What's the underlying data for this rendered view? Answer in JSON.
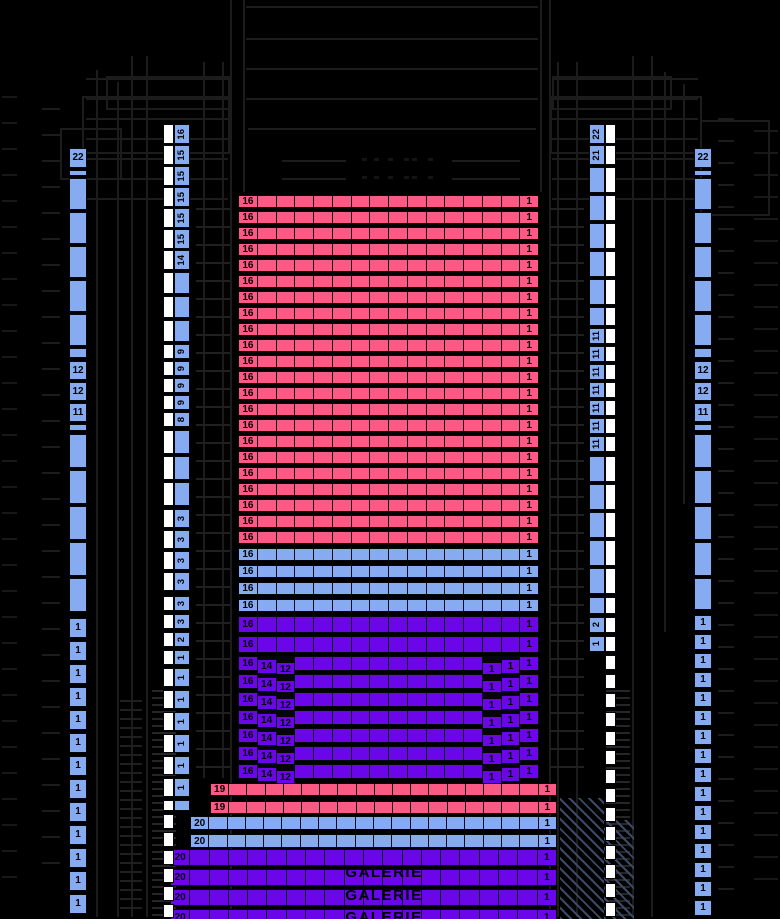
{
  "galerie": {
    "label": "GALERIE",
    "repeat": 3
  },
  "colors": {
    "pink": "#fb5a84",
    "lightblue": "#87abf1",
    "purple": "#6b06e8",
    "white": "#ffffff",
    "architecture_line": "#1c1c1c"
  },
  "parterre": {
    "pink": {
      "rows": 22,
      "seats": 16,
      "left_label": "16",
      "right_label": "1"
    },
    "lightblue": {
      "rows": 4,
      "seats": 16,
      "left_label": "16",
      "right_label": "1"
    },
    "purple_full": {
      "rows": 2,
      "seats": 16,
      "left_label": "16",
      "right_label": "1"
    },
    "purple_stepped": {
      "rows": 7,
      "seats": 16,
      "left_labels": [
        "16",
        "14",
        "12"
      ],
      "right_labels": [
        "1",
        "1",
        "1"
      ]
    }
  },
  "gallery": {
    "pink": {
      "rows": 2,
      "seats": 19,
      "left_label": "19",
      "right_label": "1"
    },
    "lightblue": {
      "rows": 2,
      "seats": 20,
      "left_label": "20",
      "right_label": "1"
    },
    "purple": {
      "rows": 4,
      "seats": 20,
      "left_label": "20",
      "right_label": "1"
    }
  },
  "strips": {
    "outer_left": [
      {
        "y": 148,
        "h": 20,
        "t": "22"
      },
      {
        "y": 170,
        "h": 6,
        "t": ""
      },
      {
        "y": 178,
        "h": 32,
        "t": ""
      },
      {
        "y": 212,
        "h": 32,
        "t": ""
      },
      {
        "y": 246,
        "h": 32,
        "t": ""
      },
      {
        "y": 280,
        "h": 32,
        "t": ""
      },
      {
        "y": 314,
        "h": 32,
        "t": ""
      },
      {
        "y": 348,
        "h": 10,
        "t": ""
      },
      {
        "y": 361,
        "h": 19,
        "t": "12"
      },
      {
        "y": 382,
        "h": 19,
        "t": "12"
      },
      {
        "y": 403,
        "h": 19,
        "t": "11"
      },
      {
        "y": 424,
        "h": 7,
        "t": ""
      },
      {
        "y": 434,
        "h": 34,
        "t": ""
      },
      {
        "y": 470,
        "h": 34,
        "t": ""
      },
      {
        "y": 506,
        "h": 34,
        "t": ""
      },
      {
        "y": 542,
        "h": 34,
        "t": ""
      },
      {
        "y": 578,
        "h": 34,
        "t": ""
      },
      {
        "y": 618,
        "h": 20,
        "t": "1"
      },
      {
        "y": 641,
        "h": 20,
        "t": "1"
      },
      {
        "y": 664,
        "h": 20,
        "t": "1"
      },
      {
        "y": 687,
        "h": 20,
        "t": "1"
      },
      {
        "y": 710,
        "h": 20,
        "t": "1"
      },
      {
        "y": 733,
        "h": 20,
        "t": "1"
      },
      {
        "y": 756,
        "h": 20,
        "t": "1"
      },
      {
        "y": 779,
        "h": 20,
        "t": "1"
      },
      {
        "y": 802,
        "h": 20,
        "t": "1"
      },
      {
        "y": 825,
        "h": 20,
        "t": "1"
      },
      {
        "y": 848,
        "h": 20,
        "t": "1"
      },
      {
        "y": 871,
        "h": 20,
        "t": "1"
      },
      {
        "y": 894,
        "h": 20,
        "t": "1"
      }
    ],
    "outer_right": [
      {
        "y": 148,
        "h": 20,
        "t": "22"
      },
      {
        "y": 170,
        "h": 6,
        "t": ""
      },
      {
        "y": 178,
        "h": 32,
        "t": ""
      },
      {
        "y": 212,
        "h": 32,
        "t": ""
      },
      {
        "y": 246,
        "h": 32,
        "t": ""
      },
      {
        "y": 280,
        "h": 32,
        "t": ""
      },
      {
        "y": 314,
        "h": 32,
        "t": ""
      },
      {
        "y": 348,
        "h": 10,
        "t": ""
      },
      {
        "y": 361,
        "h": 19,
        "t": "12"
      },
      {
        "y": 382,
        "h": 19,
        "t": "12"
      },
      {
        "y": 403,
        "h": 19,
        "t": "11"
      },
      {
        "y": 424,
        "h": 7,
        "t": ""
      },
      {
        "y": 434,
        "h": 34,
        "t": ""
      },
      {
        "y": 470,
        "h": 34,
        "t": ""
      },
      {
        "y": 506,
        "h": 34,
        "t": ""
      },
      {
        "y": 542,
        "h": 34,
        "t": ""
      },
      {
        "y": 578,
        "h": 32,
        "t": ""
      },
      {
        "y": 615,
        "h": 16,
        "t": "1"
      },
      {
        "y": 634,
        "h": 16,
        "t": "1"
      },
      {
        "y": 653,
        "h": 16,
        "t": "1"
      },
      {
        "y": 672,
        "h": 16,
        "t": "1"
      },
      {
        "y": 691,
        "h": 16,
        "t": "1"
      },
      {
        "y": 710,
        "h": 16,
        "t": "1"
      },
      {
        "y": 729,
        "h": 16,
        "t": "1"
      },
      {
        "y": 748,
        "h": 16,
        "t": "1"
      },
      {
        "y": 767,
        "h": 16,
        "t": "1"
      },
      {
        "y": 786,
        "h": 16,
        "t": "1"
      },
      {
        "y": 805,
        "h": 16,
        "t": "1"
      },
      {
        "y": 824,
        "h": 16,
        "t": "1"
      },
      {
        "y": 843,
        "h": 16,
        "t": "1"
      },
      {
        "y": 862,
        "h": 16,
        "t": "1"
      },
      {
        "y": 881,
        "h": 16,
        "t": "1"
      },
      {
        "y": 900,
        "h": 16,
        "t": "1"
      }
    ],
    "inner_left": [
      {
        "y": 124,
        "h": 20,
        "t": "16"
      },
      {
        "y": 145,
        "h": 20,
        "t": "15"
      },
      {
        "y": 166,
        "h": 20,
        "t": "15"
      },
      {
        "y": 187,
        "h": 20,
        "t": "15"
      },
      {
        "y": 208,
        "h": 20,
        "t": "15"
      },
      {
        "y": 229,
        "h": 20,
        "t": "15"
      },
      {
        "y": 250,
        "h": 20,
        "t": "14"
      },
      {
        "y": 272,
        "h": 22,
        "t": ""
      },
      {
        "y": 296,
        "h": 22,
        "t": ""
      },
      {
        "y": 320,
        "h": 22,
        "t": ""
      },
      {
        "y": 344,
        "h": 15,
        "t": "9"
      },
      {
        "y": 361,
        "h": 15,
        "t": "9"
      },
      {
        "y": 378,
        "h": 15,
        "t": "9"
      },
      {
        "y": 395,
        "h": 15,
        "t": "9"
      },
      {
        "y": 412,
        "h": 15,
        "t": "8"
      },
      {
        "y": 430,
        "h": 24,
        "t": ""
      },
      {
        "y": 456,
        "h": 24,
        "t": ""
      },
      {
        "y": 482,
        "h": 24,
        "t": ""
      },
      {
        "y": 509,
        "h": 19,
        "t": "3"
      },
      {
        "y": 530,
        "h": 19,
        "t": "3"
      },
      {
        "y": 551,
        "h": 19,
        "t": "3"
      },
      {
        "y": 572,
        "h": 19,
        "t": "3"
      },
      {
        "y": 596,
        "h": 15,
        "t": "3"
      },
      {
        "y": 614,
        "h": 15,
        "t": "3"
      },
      {
        "y": 632,
        "h": 15,
        "t": "2"
      },
      {
        "y": 650,
        "h": 15,
        "t": "1"
      },
      {
        "y": 668,
        "h": 19,
        "t": "1"
      },
      {
        "y": 690,
        "h": 19,
        "t": "1"
      },
      {
        "y": 712,
        "h": 19,
        "t": "1"
      },
      {
        "y": 734,
        "h": 19,
        "t": "1"
      },
      {
        "y": 756,
        "h": 19,
        "t": "1"
      },
      {
        "y": 778,
        "h": 19,
        "t": "1"
      },
      {
        "y": 800,
        "h": 11,
        "t": ""
      },
      {
        "y": 814,
        "h": 15,
        "t": "",
        "w": 1
      },
      {
        "y": 832,
        "h": 15,
        "t": "",
        "w": 1
      },
      {
        "y": 850,
        "h": 15,
        "t": "",
        "w": 1
      },
      {
        "y": 868,
        "h": 15,
        "t": "",
        "w": 1
      },
      {
        "y": 886,
        "h": 15,
        "t": "",
        "w": 1
      },
      {
        "y": 904,
        "h": 14,
        "t": "",
        "w": 1
      }
    ],
    "inner_right": [
      {
        "y": 124,
        "h": 20,
        "t": "22"
      },
      {
        "y": 145,
        "h": 20,
        "t": "21"
      },
      {
        "y": 167,
        "h": 26,
        "t": ""
      },
      {
        "y": 195,
        "h": 26,
        "t": ""
      },
      {
        "y": 223,
        "h": 26,
        "t": ""
      },
      {
        "y": 251,
        "h": 26,
        "t": ""
      },
      {
        "y": 279,
        "h": 26,
        "t": ""
      },
      {
        "y": 307,
        "h": 19,
        "t": ""
      },
      {
        "y": 328,
        "h": 16,
        "t": "11"
      },
      {
        "y": 346,
        "h": 16,
        "t": "11"
      },
      {
        "y": 364,
        "h": 16,
        "t": "11"
      },
      {
        "y": 382,
        "h": 16,
        "t": "11"
      },
      {
        "y": 400,
        "h": 16,
        "t": "11"
      },
      {
        "y": 418,
        "h": 16,
        "t": "11"
      },
      {
        "y": 436,
        "h": 16,
        "t": "11"
      },
      {
        "y": 456,
        "h": 26,
        "t": ""
      },
      {
        "y": 484,
        "h": 26,
        "t": ""
      },
      {
        "y": 512,
        "h": 26,
        "t": ""
      },
      {
        "y": 540,
        "h": 26,
        "t": ""
      },
      {
        "y": 568,
        "h": 26,
        "t": ""
      },
      {
        "y": 597,
        "h": 17,
        "t": ""
      },
      {
        "y": 617,
        "h": 16,
        "t": "2"
      },
      {
        "y": 636,
        "h": 16,
        "t": "1"
      },
      {
        "y": 655,
        "h": 15,
        "t": "",
        "w": 1
      },
      {
        "y": 674,
        "h": 15,
        "t": "",
        "w": 1
      },
      {
        "y": 693,
        "h": 15,
        "t": "",
        "w": 1
      },
      {
        "y": 712,
        "h": 15,
        "t": "",
        "w": 1
      },
      {
        "y": 731,
        "h": 15,
        "t": "",
        "w": 1
      },
      {
        "y": 750,
        "h": 15,
        "t": "",
        "w": 1
      },
      {
        "y": 769,
        "h": 15,
        "t": "",
        "w": 1
      },
      {
        "y": 788,
        "h": 15,
        "t": "",
        "w": 1
      },
      {
        "y": 807,
        "h": 15,
        "t": "",
        "w": 1
      },
      {
        "y": 826,
        "h": 15,
        "t": "",
        "w": 1
      },
      {
        "y": 845,
        "h": 15,
        "t": "",
        "w": 1
      },
      {
        "y": 864,
        "h": 15,
        "t": "",
        "w": 1
      },
      {
        "y": 883,
        "h": 15,
        "t": "",
        "w": 1
      },
      {
        "y": 902,
        "h": 15,
        "t": "",
        "w": 1
      }
    ]
  }
}
